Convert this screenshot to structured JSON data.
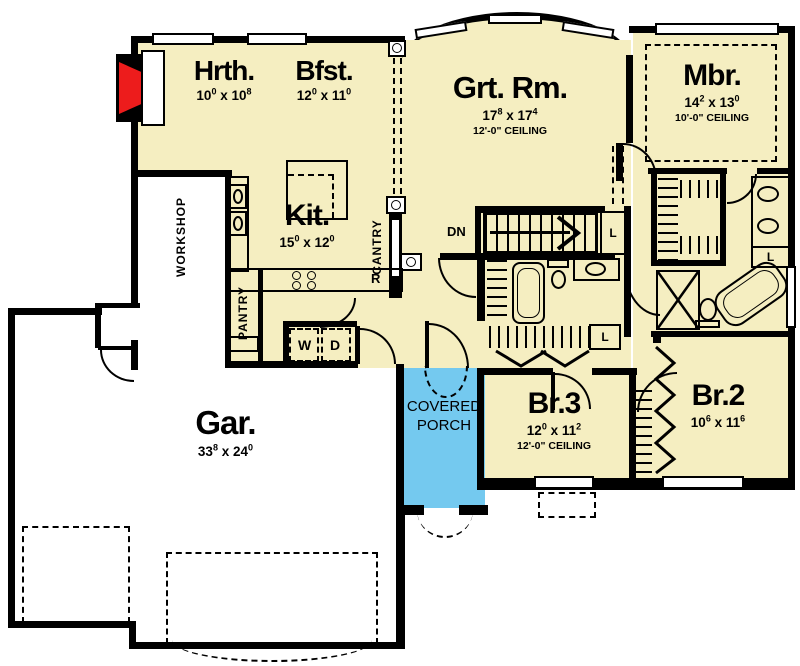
{
  "shared": {
    "x": "x"
  },
  "rooms": {
    "hrth": {
      "name": "Hrth.",
      "a": "10",
      "as": "0",
      "b": "10",
      "bs": "8"
    },
    "bfst": {
      "name": "Bfst.",
      "a": "12",
      "as": "0",
      "b": "11",
      "bs": "0"
    },
    "grt": {
      "name": "Grt. Rm.",
      "a": "17",
      "as": "8",
      "b": "17",
      "bs": "4",
      "ceiling": "12'-0\" CEILING"
    },
    "mbr": {
      "name": "Mbr.",
      "a": "14",
      "as": "2",
      "b": "13",
      "bs": "0",
      "ceiling": "10'-0\" CEILING"
    },
    "kit": {
      "name": "Kit.",
      "a": "15",
      "as": "0",
      "b": "12",
      "bs": "0"
    },
    "gar": {
      "name": "Gar.",
      "a": "33",
      "as": "8",
      "b": "24",
      "bs": "0"
    },
    "br3": {
      "name": "Br.3",
      "a": "12",
      "as": "0",
      "b": "11",
      "bs": "2",
      "ceiling": "12'-0\" CEILING"
    },
    "br2": {
      "name": "Br.2",
      "a": "10",
      "as": "6",
      "b": "11",
      "bs": "6"
    }
  },
  "porch": {
    "line1": "COVERED",
    "line2": "PORCH"
  },
  "labels": {
    "workshop": "WORKSHOP",
    "pantry": "PANTRY",
    "cantry": "CANTRY",
    "dn": "DN",
    "r": "R",
    "w": "W",
    "d": "D",
    "l": "L"
  },
  "colors": {
    "floor": "#F5EEC1",
    "porch": "#74C9EF",
    "wall": "#000000",
    "fireplace": "#ED1C1C",
    "background": "#FFFFFF"
  }
}
